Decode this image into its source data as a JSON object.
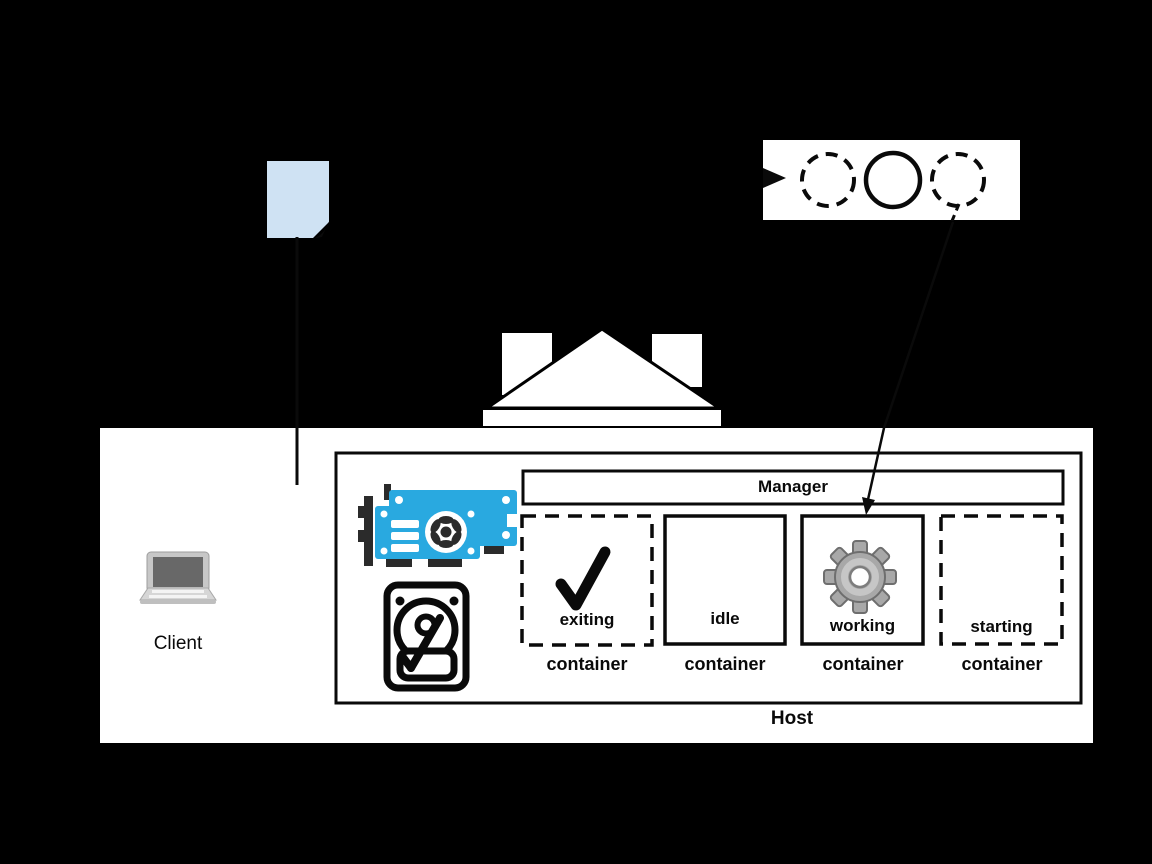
{
  "diagram_title": "container lifecycle / host architecture diagram",
  "colors": {
    "background": "#000000",
    "document_blue": "#CFE2F3",
    "gpu_blue": "#29A9E0",
    "gear_gray": "#A8A8A8",
    "panel_white": "#FFFFFF",
    "line_black": "#0A0A0A"
  },
  "client": {
    "label": "Client",
    "icon": "laptop-icon"
  },
  "document": {
    "icon": "document-icon"
  },
  "lifecycle_box": {
    "icon": "state-circles",
    "circles": [
      {
        "style": "dashed"
      },
      {
        "style": "solid"
      },
      {
        "style": "dashed"
      }
    ],
    "incoming_arrow": true
  },
  "house_shape": {
    "icon": "house-icon"
  },
  "host": {
    "label": "Host",
    "manager": {
      "label": "Manager"
    },
    "resources": [
      {
        "icon": "gpu-icon"
      },
      {
        "icon": "hdd-icon"
      }
    ],
    "containers": [
      {
        "state": "exiting",
        "label": "container",
        "border": "dashed",
        "icon": "checkmark-icon"
      },
      {
        "state": "idle",
        "label": "container",
        "border": "solid",
        "icon": null
      },
      {
        "state": "working",
        "label": "container",
        "border": "solid",
        "icon": "gear-icon"
      },
      {
        "state": "starting",
        "label": "container",
        "border": "dashed",
        "icon": null
      }
    ]
  }
}
